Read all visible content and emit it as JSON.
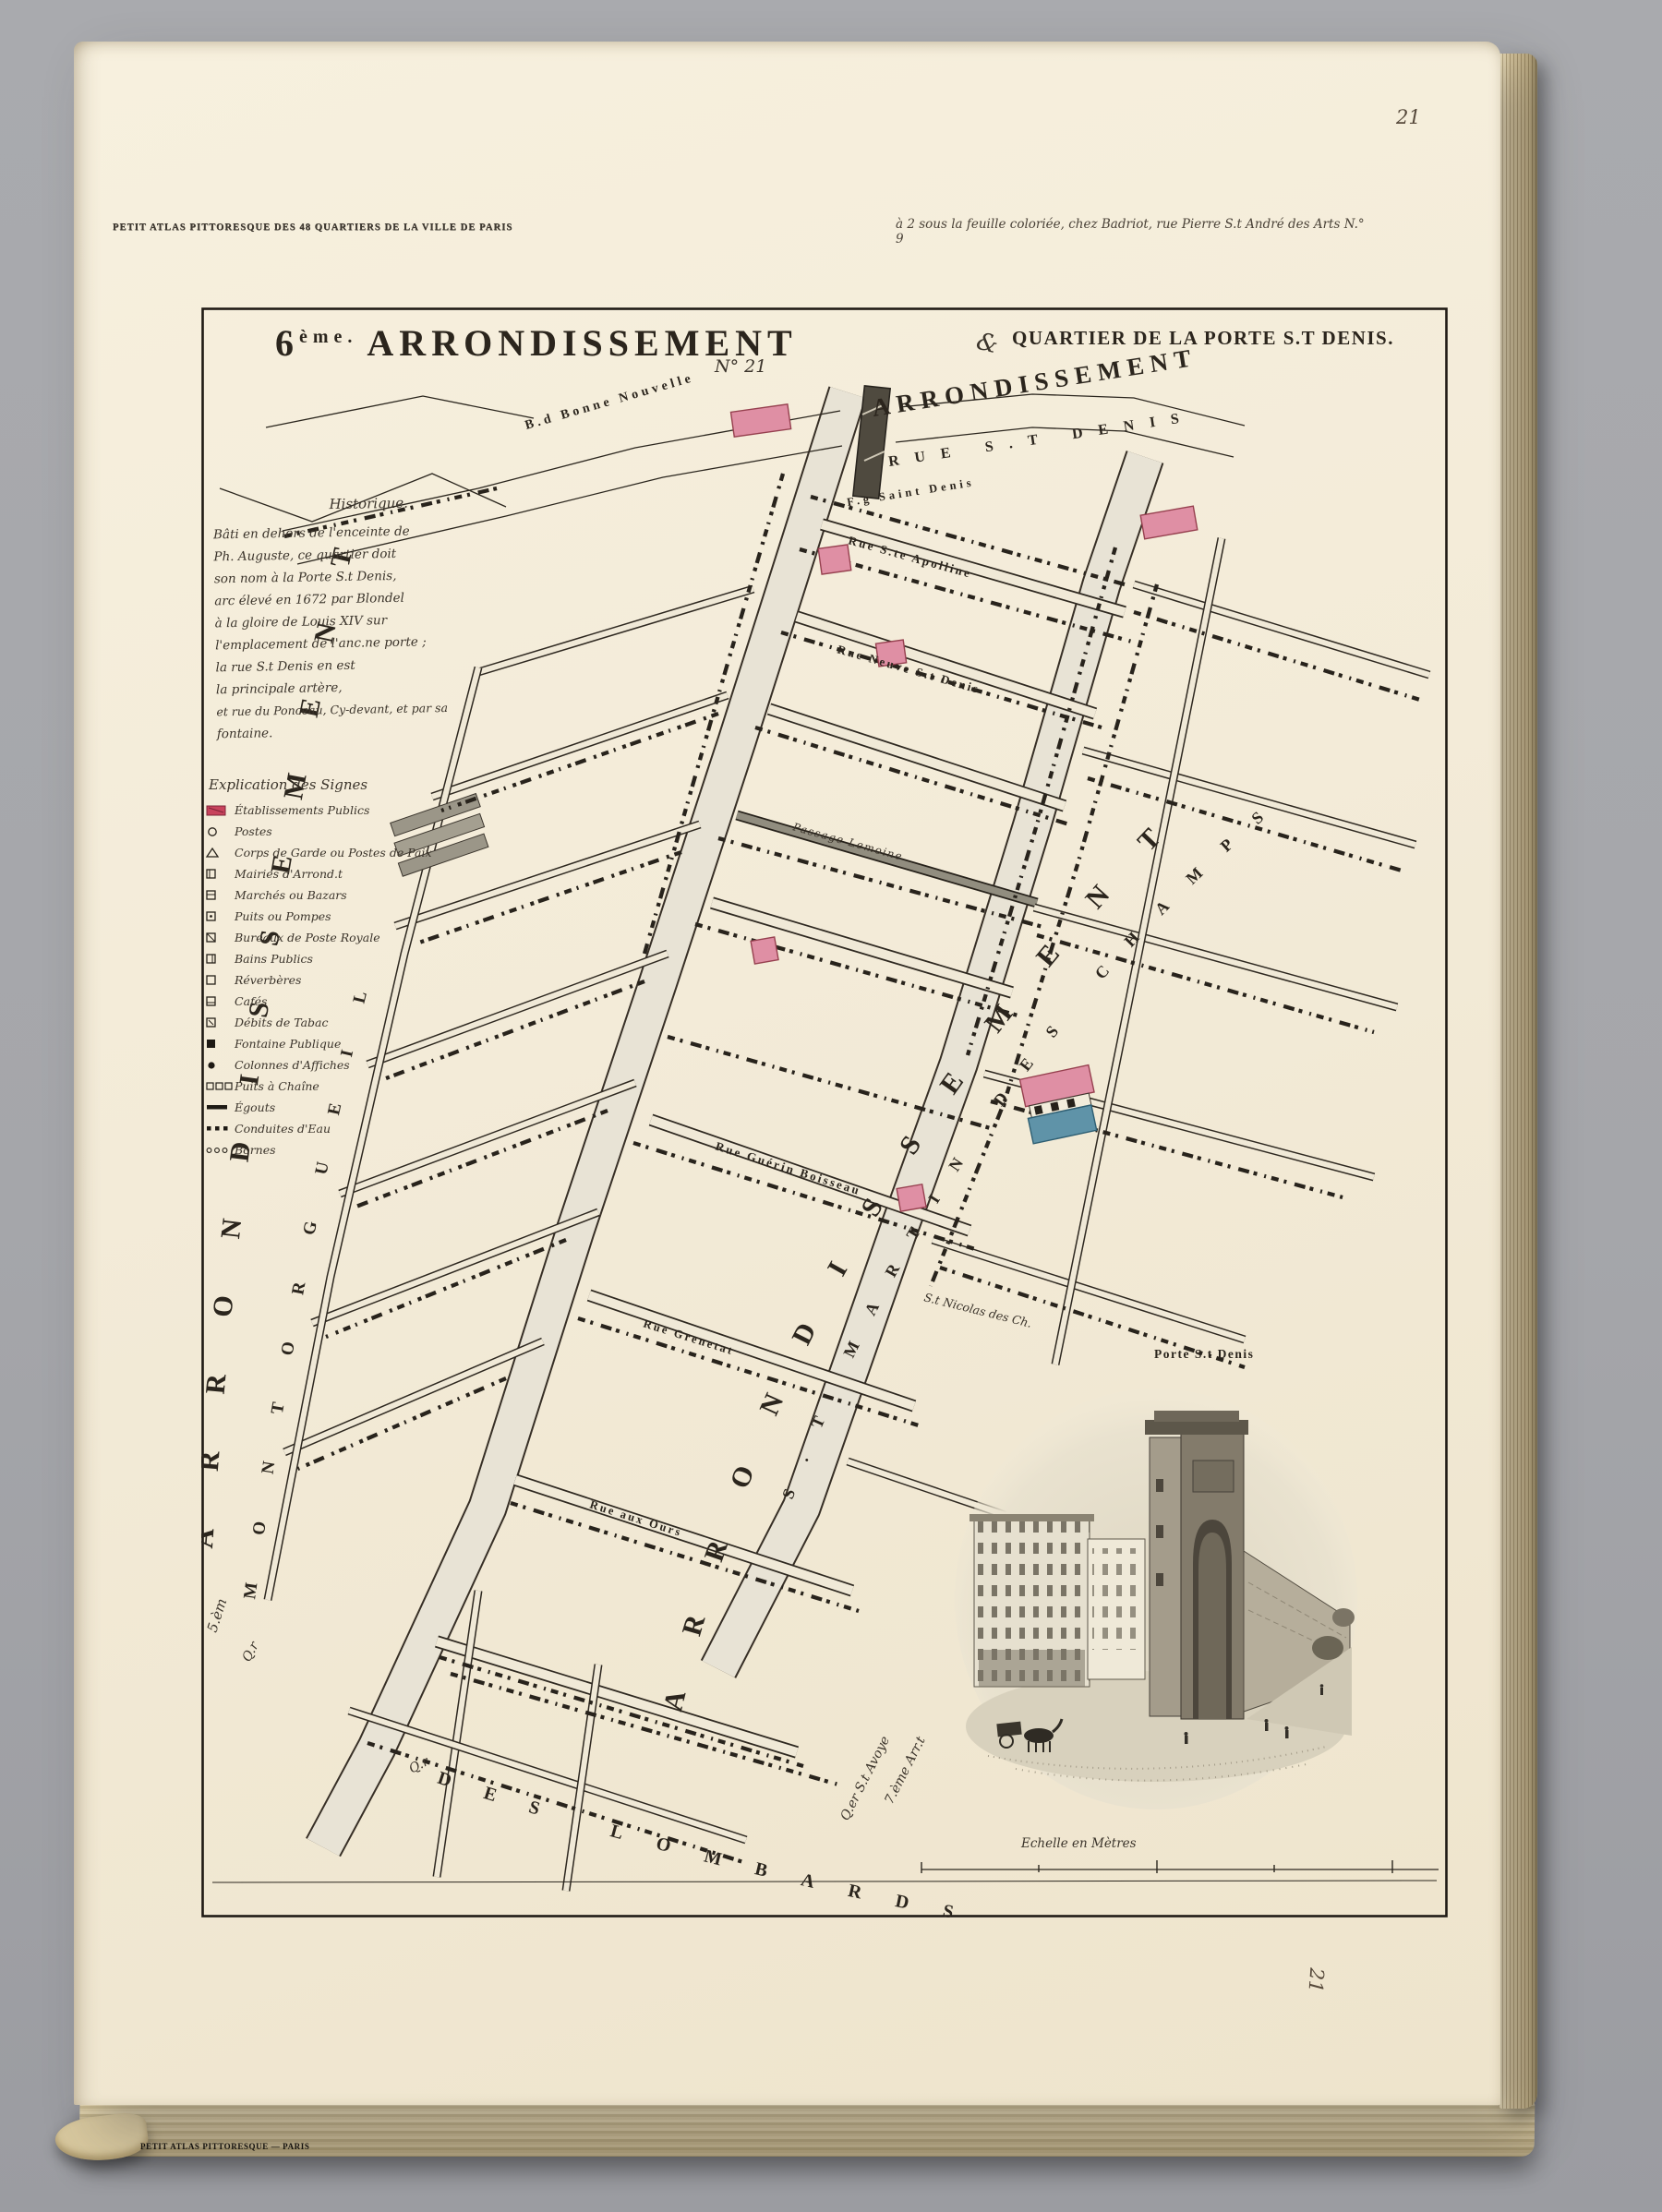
{
  "page": {
    "folio_top": "21",
    "folio_side": "21",
    "plate_stamp": "PETIT ATLAS PITTORESQUE — PARIS"
  },
  "header": {
    "series_title": "PETIT ATLAS PITTORESQUE DES 48 QUARTIERS DE LA VILLE DE PARIS",
    "imprint_note": "à 2 sous la feuille coloriée, chez Badriot, rue Pierre S.t André des Arts N.° 9"
  },
  "title": {
    "num": "6",
    "ord": "ème.",
    "name": "ARRONDISSEMENT",
    "flourish": "&",
    "plate_no": "N° 21",
    "quartier": "QUARTIER DE LA PORTE S.T DENIS."
  },
  "map": {
    "north_arrondissement": "ARRONDISSEMENT",
    "north_street": "RUE S.T DENIS",
    "faubourg": "F.g Saint Denis",
    "boulevard": "B.d Bonne Nouvelle",
    "church": "S.t Nicolas des Ch.",
    "streets": [
      {
        "label": "Rue S.te Apolline"
      },
      {
        "label": "Rue Neuve S.t Denis"
      },
      {
        "label": "Passage Lemoine"
      },
      {
        "label": "Rue Guérin Boisseau"
      },
      {
        "label": "Rue Grenetat"
      },
      {
        "label": "Rue aux Ours"
      }
    ],
    "arcs": {
      "left_big": "ARRONDISSEMENT",
      "left_prefix": "5.èm",
      "left_q_prefix": "Q.r",
      "left_quarter": "MONTORGUEIL",
      "bottom_q_prefix": "Q.r",
      "bottom_quarter": "DES LOMBARDS",
      "right_big": "ARRONDISSEMENT",
      "right_quarter": "S.T MARTIN DES CHAMPS",
      "avoye_quarter": "Q.er S.t Avoye",
      "avoye_arrt": "7.ème Arr.t"
    }
  },
  "notes": {
    "heading": "Historique.",
    "lines": [
      "Bâti en dehors de l'enceinte de",
      "Ph. Auguste, ce quartier doit",
      "son nom à la Porte S.t Denis,",
      "arc élevé en 1672 par Blondel",
      "à la gloire de Louis XIV sur",
      "l'emplacement de l'anc.ne porte ;",
      "la rue S.t Denis en est",
      "la principale artère,",
      "et rue du Ponceau, Cy-devant, et par sa",
      "fontaine."
    ]
  },
  "legend": {
    "heading": "Explication des Signes",
    "items": [
      {
        "symbol": "swatch-red",
        "label": "Établissements Publics"
      },
      {
        "symbol": "circle",
        "label": "Postes"
      },
      {
        "symbol": "triangle",
        "label": "Corps de Garde ou Postes de Paix"
      },
      {
        "symbol": "square",
        "label": "Mairies d'Arrond.t"
      },
      {
        "symbol": "square",
        "label": "Marchés ou Bazars"
      },
      {
        "symbol": "square",
        "label": "Puits ou Pompes"
      },
      {
        "symbol": "square",
        "label": "Bureaux de Poste Royale"
      },
      {
        "symbol": "square",
        "label": "Bains Publics"
      },
      {
        "symbol": "square",
        "label": "Réverbères"
      },
      {
        "symbol": "square",
        "label": "Cafés"
      },
      {
        "symbol": "square",
        "label": "Débits de Tabac"
      },
      {
        "symbol": "square-filled",
        "label": "Fontaine Publique"
      },
      {
        "symbol": "circle-filled",
        "label": "Colonnes d'Affiches"
      },
      {
        "symbol": "squares-3",
        "label": "Puits à Chaîne"
      },
      {
        "symbol": "line-thick",
        "label": "Égouts"
      },
      {
        "symbol": "dots-filled",
        "label": "Conduites d'Eau"
      },
      {
        "symbol": "dots-open",
        "label": "Bornes"
      }
    ]
  },
  "vignette": {
    "caption": "Porte S.t Denis"
  },
  "scale": {
    "caption": "Echelle en Mètres"
  },
  "colors": {
    "accent_pink": "#df8fa4",
    "accent_blue": "#5f93a8",
    "paper": "#f3ebd8",
    "ink": "#2b251d"
  }
}
